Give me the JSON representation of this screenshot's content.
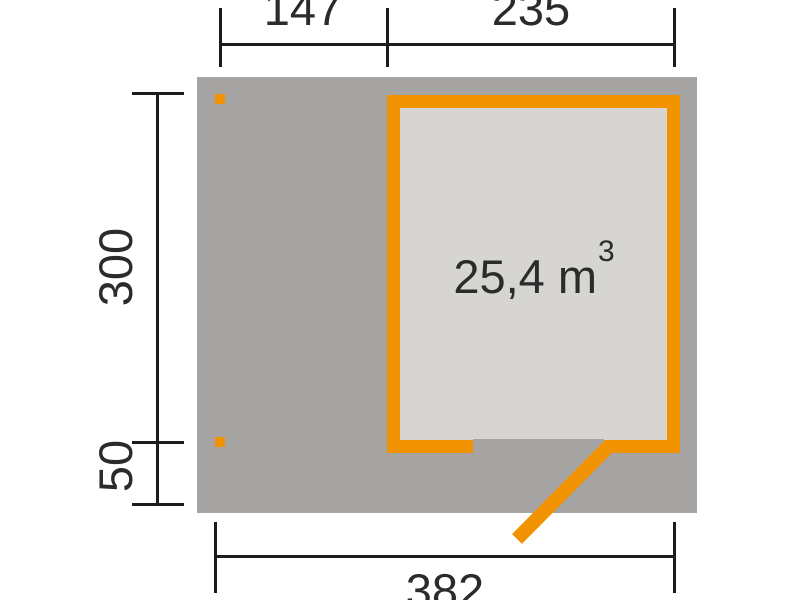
{
  "title": "Garden house floor plan with volume and dimensions",
  "colors": {
    "accent": "#F19300",
    "footprint": "#A5A4A3",
    "room_fill": "#D7D5D2",
    "line": "#1C1C1C",
    "text": "#2B2B2B",
    "background": "#FFFFFF"
  },
  "room": {
    "volume_value": "25,4 m",
    "volume_exponent": "3"
  },
  "dimensions": {
    "top_left": "147",
    "top_right": "235",
    "left_upper": "300",
    "left_lower": "50",
    "bottom": "382"
  }
}
